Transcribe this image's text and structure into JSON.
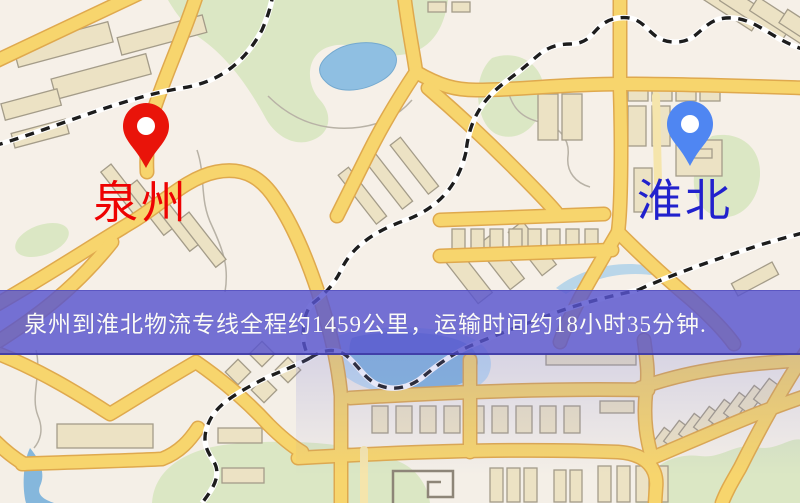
{
  "window": {
    "width": 800,
    "height": 503,
    "kind": "logistics-route-map"
  },
  "map": {
    "type": "road-map",
    "origin": {
      "label": "泉州",
      "pin_color": "#e9140a",
      "label_color": "#ee0202"
    },
    "destination": {
      "label": "淮北",
      "pin_color": "#4f86f2",
      "label_color": "#2121cd"
    }
  },
  "banner": {
    "text": "泉州到淮北物流专线全程约1459公里，运输时间约18小时35分钟.",
    "distance_km": "1459",
    "duration": "18小时35分钟",
    "background": "#5854ce",
    "text_color": "#fbfbf7"
  },
  "palette": {
    "background": "#f4efe7",
    "road_fill": "#f7d56d",
    "road_edge": "#dfa94e",
    "minor_road": "#f5e5ac",
    "park": "#dbe7c4",
    "water": "#8fbfe2",
    "railway": "#1d1d1d",
    "building_fill": "#ece2c4",
    "building_edge": "#a49c89"
  }
}
